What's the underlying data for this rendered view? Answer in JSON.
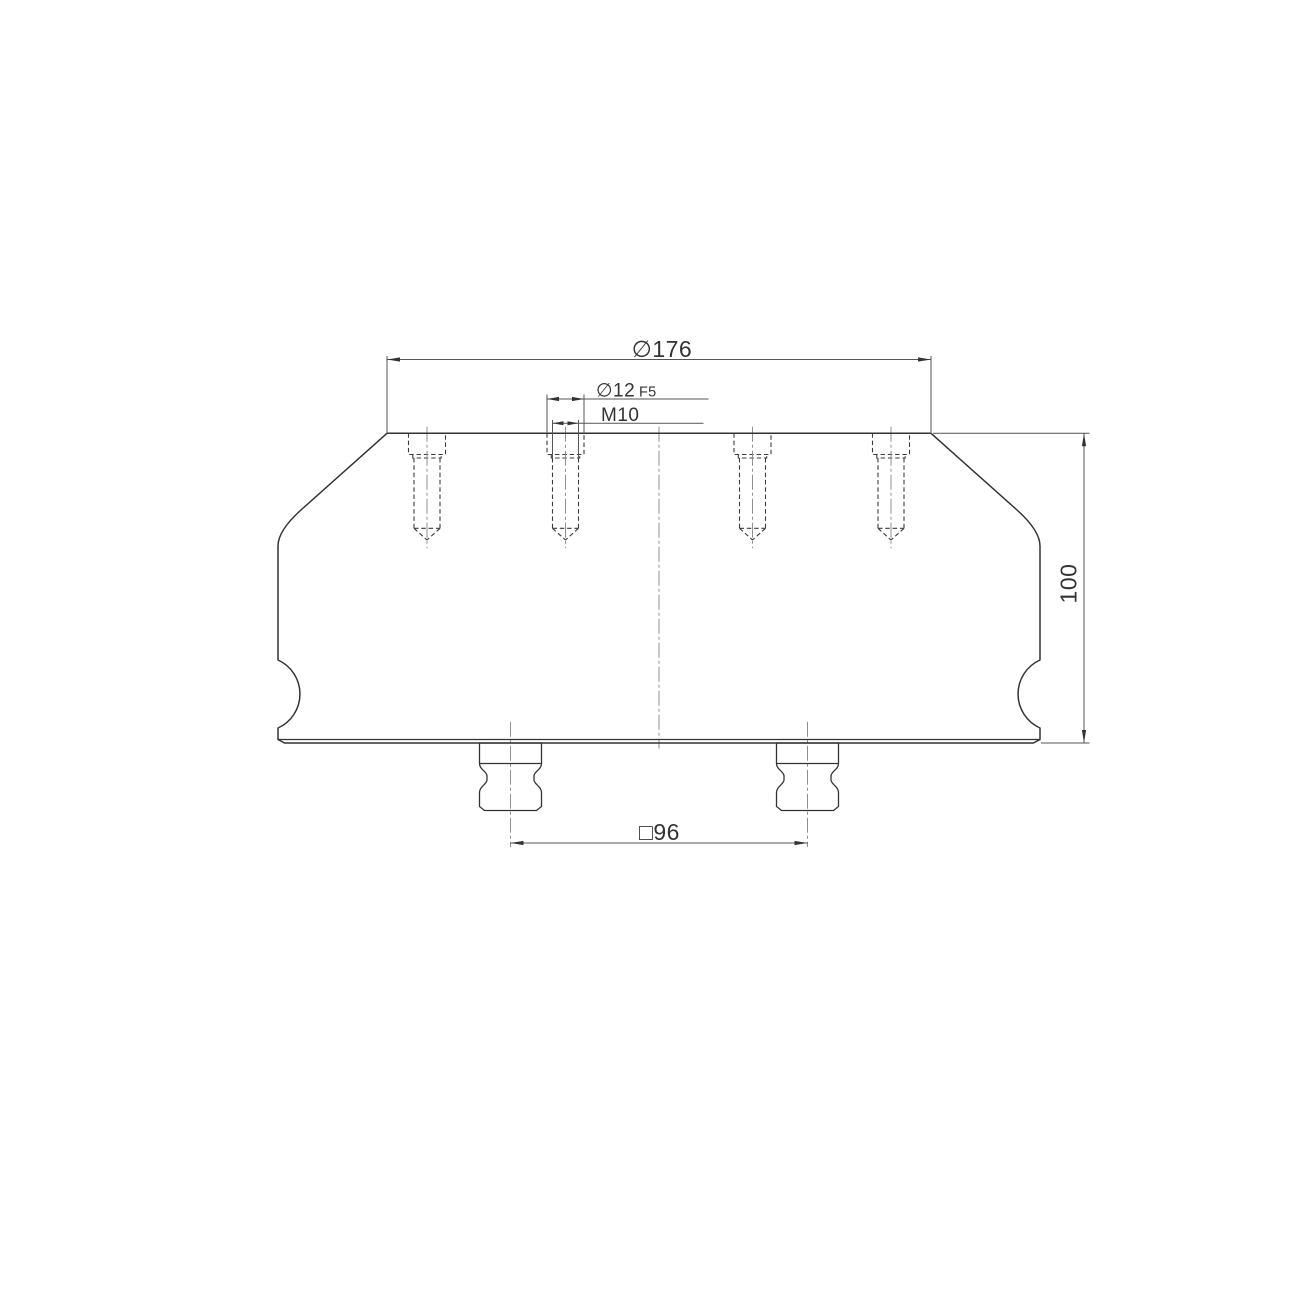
{
  "page": {
    "background_color": "#ffffff"
  },
  "drawing": {
    "palette": {
      "outline": "#333333",
      "hidden_line": "#3d3d3d",
      "centerline": "#8f8f8f",
      "dimension_line": "#555555",
      "text": "#333333"
    },
    "dimensions": {
      "outer_diameter": "∅176",
      "fit_diameter": "∅12",
      "fit_tolerance": "F5",
      "thread": "M10",
      "height": "100",
      "square_spacing": "□96"
    }
  }
}
